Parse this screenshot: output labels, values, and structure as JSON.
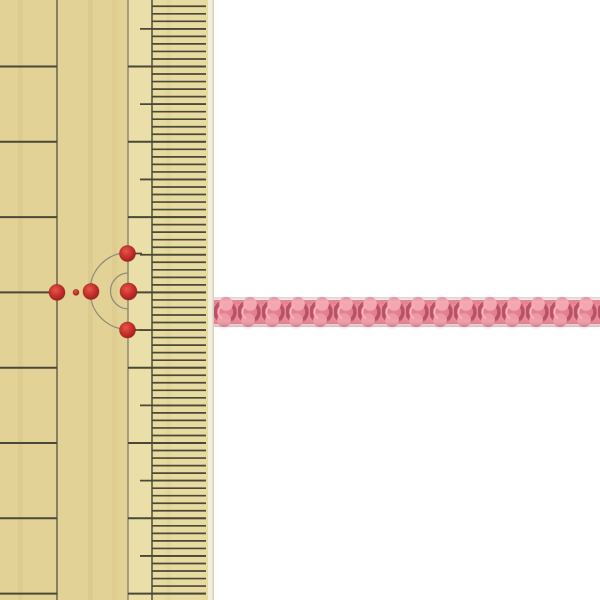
{
  "meta": {
    "description": "Product photograph: a pink braided craft cord laid horizontally, its width shown against a traditional Japanese bamboo ruler occupying the left side of the frame. No text visible."
  },
  "scene": {
    "width": 600,
    "height": 600,
    "background_color": "#ffffff",
    "ruler": {
      "label": "bamboo-ruler",
      "width": 214,
      "colors": {
        "wood": "#e3d295",
        "wood_mid_strip": "#eadfa9",
        "wood_fine_zone": "#e8dba1",
        "bevel": "#f3eed9",
        "edge_line": "#d8d4c0",
        "tick": "#4a4836",
        "vline_left": "#6e6b54",
        "vline_mid": "#827f68",
        "vline_fine": "#5a5742",
        "arc": "#8f8c7a",
        "dot_center": "#e25847",
        "dot_main": "#c62d2a",
        "dot_rim": "#931d20"
      },
      "lines": {
        "left": 57,
        "mid": 128,
        "fine": 152
      },
      "half_tick_start_x": 140,
      "tick_end_x": 206,
      "major_tick_start_y": 66.5,
      "major_tick_spacing": 75.3,
      "major_tick_count": 8,
      "fine_divisions_per_major": 10,
      "dot_row_stub_ys": [
        253.5,
        330
      ],
      "red_dots": [
        {
          "x": 57,
          "y": 292.4,
          "r": 8
        },
        {
          "x": 76,
          "y": 292.4,
          "r": 3
        },
        {
          "x": 91,
          "y": 291.5,
          "r": 8
        },
        {
          "x": 127.5,
          "y": 253.5,
          "r": 8
        },
        {
          "x": 128.5,
          "y": 291.5,
          "r": 8.5
        },
        {
          "x": 127.5,
          "y": 330,
          "r": 8
        }
      ],
      "arcs": [
        {
          "cx": 128.5,
          "cy": 291,
          "r": 38.5
        },
        {
          "cx": 128.5,
          "cy": 291,
          "r": 18
        }
      ]
    },
    "cord": {
      "label": "pink-braided-cord",
      "x": 214,
      "y": 297,
      "width": 386,
      "height": 30,
      "braid_unit": 24,
      "colors": {
        "base": "#e5808e",
        "connector": "#e98c99",
        "shadow": "#b85266",
        "highlight_top": "#f3a7b1",
        "highlight_bottom": "#ee9aa6",
        "sheen": "#f7b8c0",
        "edge_shade_top": "rgba(170,70,90,0.28)",
        "edge_shade_bottom": "rgba(150,55,75,0.32)"
      }
    }
  }
}
